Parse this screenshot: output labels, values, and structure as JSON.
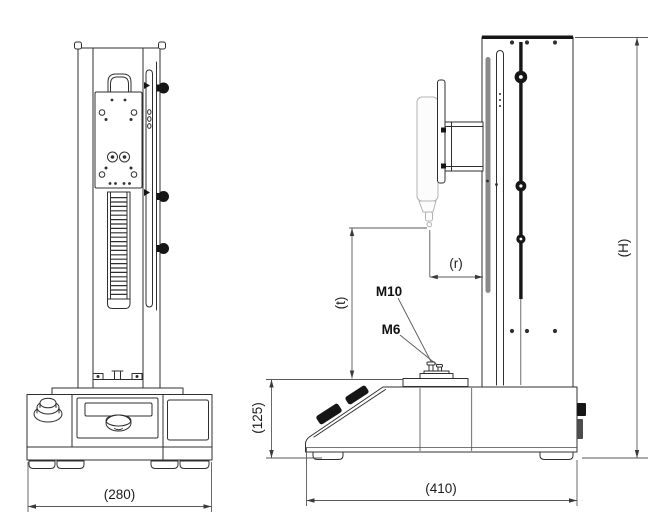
{
  "drawing": {
    "background": "#ffffff",
    "stroke_color": "#2f2f2f",
    "accent_black": "#161616",
    "rail_gray": "#8a8a8a",
    "dim_labels": {
      "front_base_width": "(280)",
      "side_base_depth": "(410)",
      "base_height": "(125)",
      "test_stroke": "(t)",
      "throat_depth": "(r)",
      "stand_height": "(H)"
    },
    "thread_labels": {
      "m10": "M10",
      "m6": "M6"
    }
  }
}
